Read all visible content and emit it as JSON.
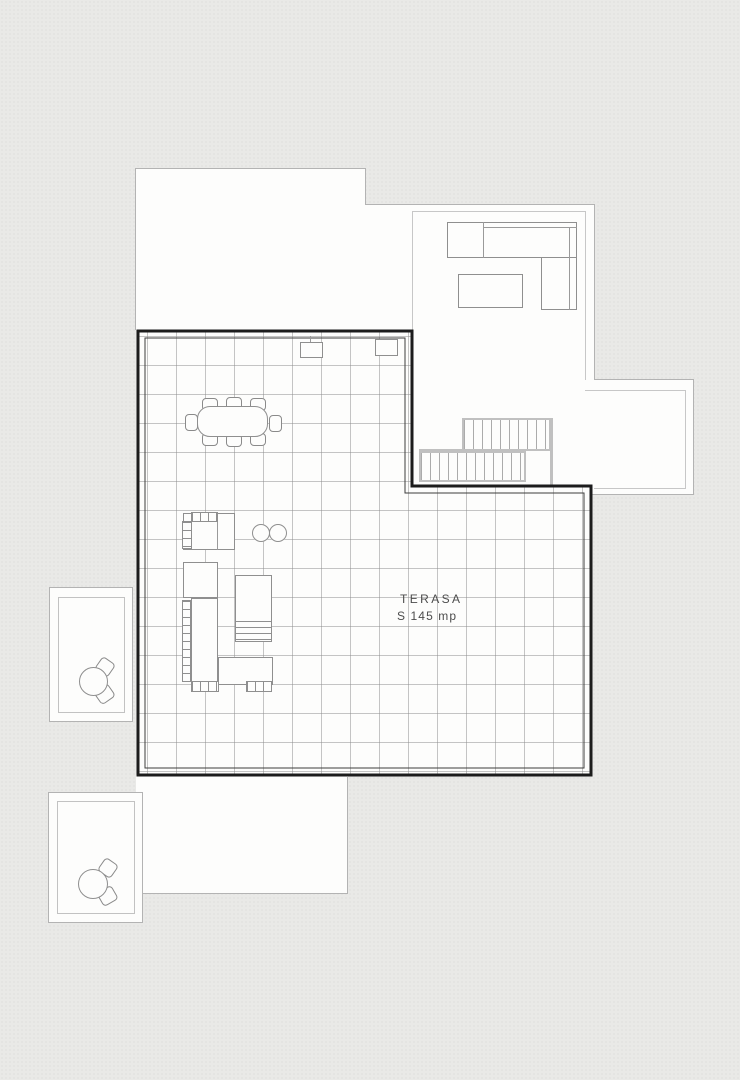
{
  "labels": {
    "terrace_name": "TERASA",
    "terrace_area": "S 145 mp"
  },
  "colors": {
    "background": "#e9e9e7",
    "paper_white": "#fdfdfc",
    "terrace_border": "#1c1c1c",
    "terrace_inner_line": "#3d3d3d",
    "grid_line": "#8c8c8c",
    "building_outline": "#b3b3b3",
    "inner_wall_line": "#c7c7c7",
    "furniture_stroke": "#8f8f8f",
    "stair_stroke": "#c0c0c0",
    "label_text": "#4c4c4c"
  },
  "symbols": {
    "terrace_floor": "square-tile-grid",
    "dining_set": "rectangular-table-8-chairs",
    "outdoor_kitchen": "counter-with-grill-hatch",
    "stools": "two-circles",
    "lounger": "rectangle-with-slats",
    "sofa": "l-shaped-sofa",
    "coffee_table": "rectangle",
    "stairs": "two-flights-with-treads",
    "balcony_set": "round-table-two-chairs"
  }
}
